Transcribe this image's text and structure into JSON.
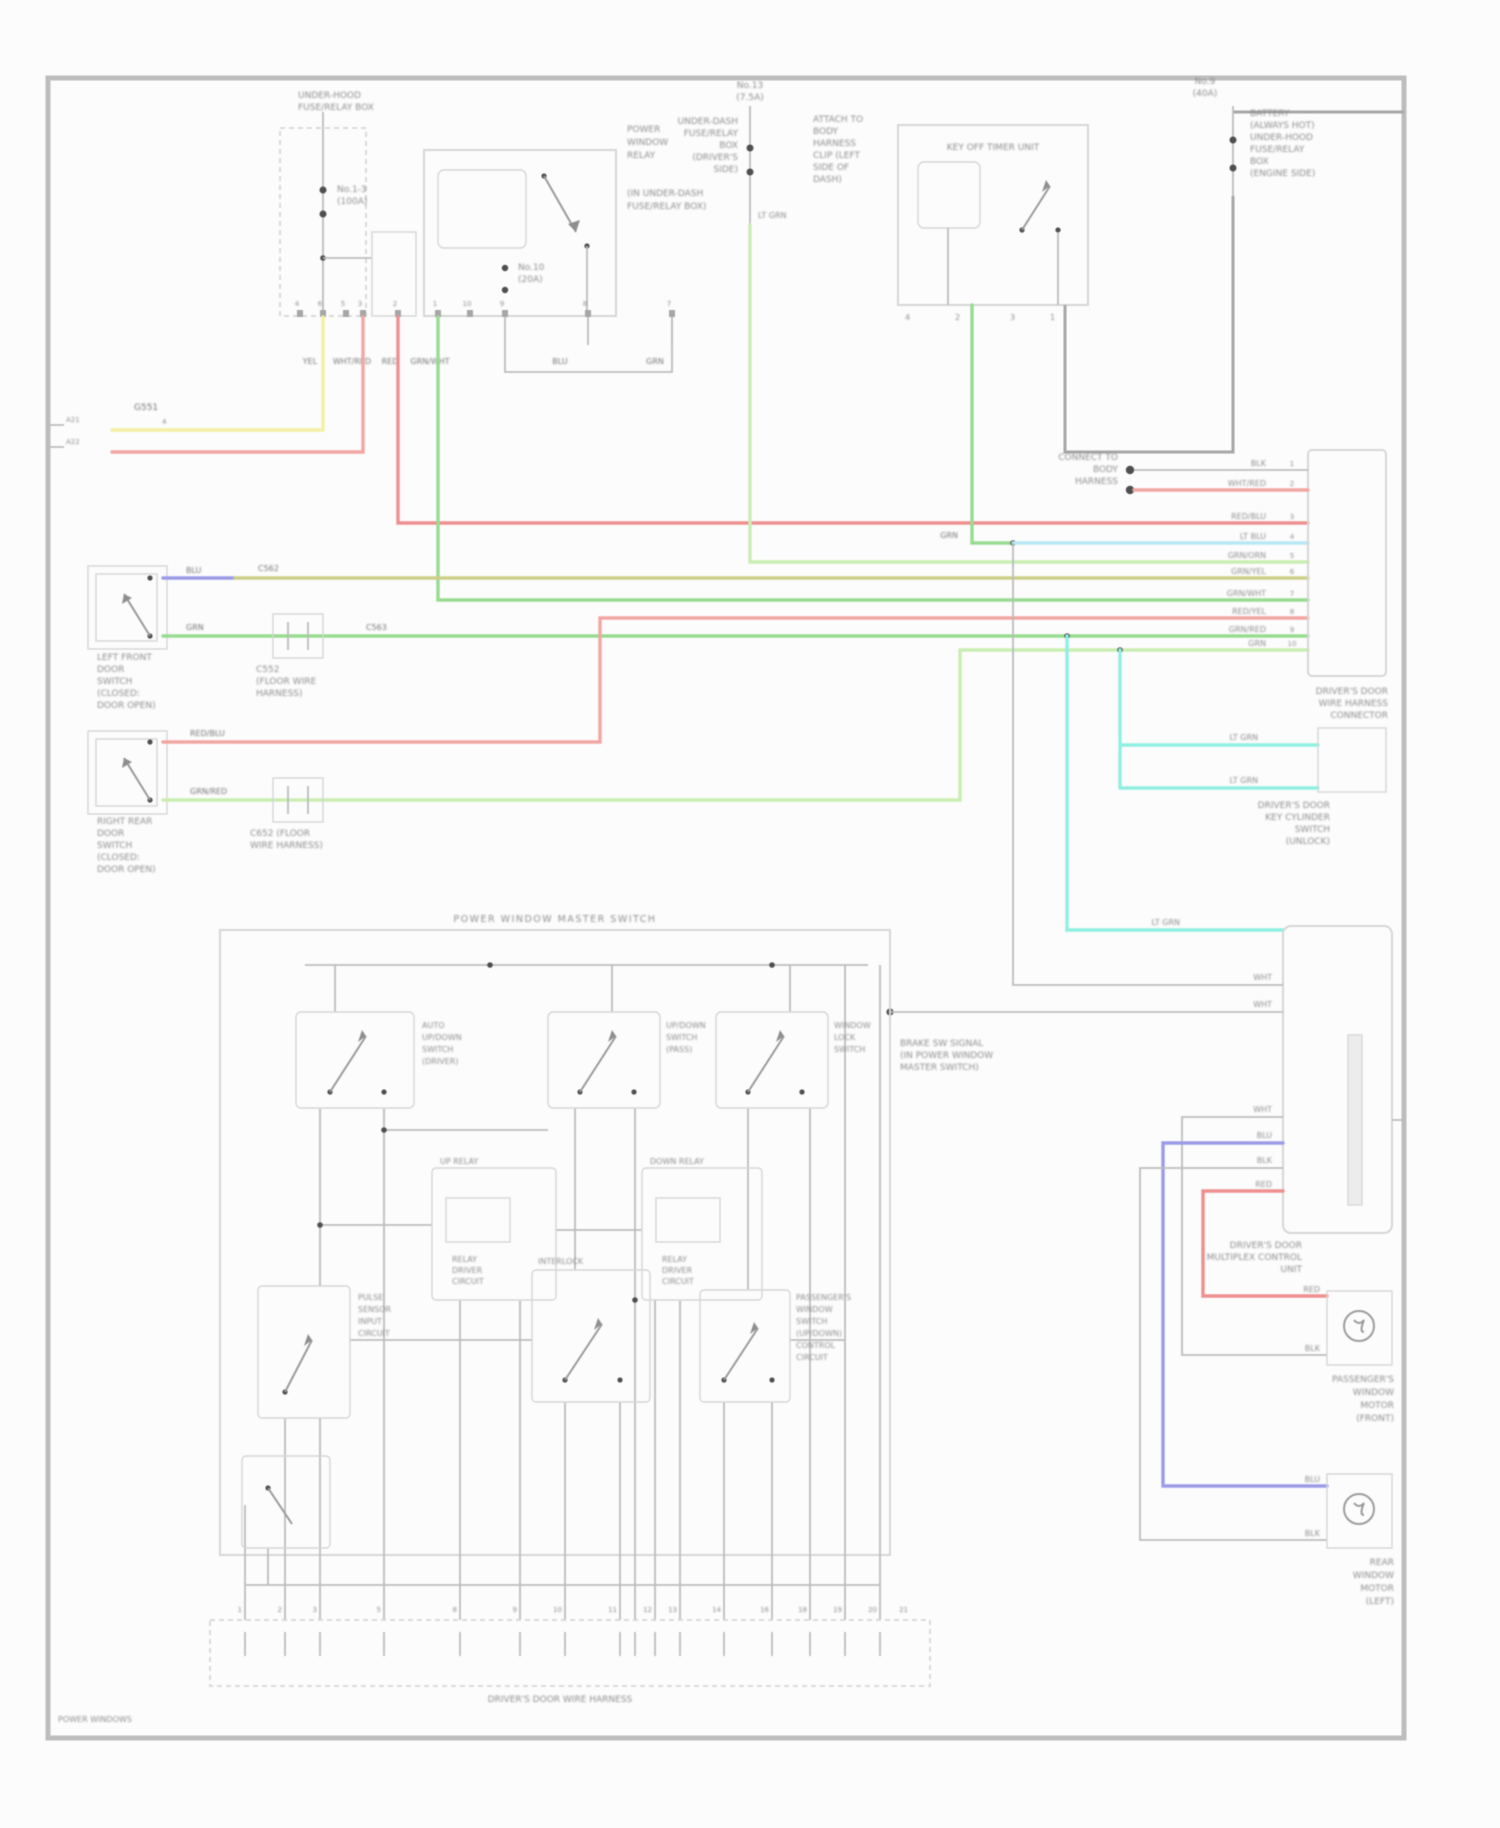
{
  "colors": {
    "page_bg": "#fcfcfc",
    "border": "#bdbdbd",
    "box": "#d6d6d6",
    "wire": "#bcbcbc",
    "wire_dark": "#a6a6a6",
    "text": "#8e8e8e",
    "text_dark": "#767676",
    "yellow": "#f4efa4",
    "red": "#f2a6a2",
    "red2": "#ee8f8f",
    "green": "#97db90",
    "palegreen": "#c9edb2",
    "olive": "#cdd089",
    "ltblue": "#b8e7f3",
    "cyan": "#90f0e2",
    "blue": "#9b9ce8",
    "dot": "#4f4f4f"
  },
  "page": {
    "footer": "POWER WINDOWS"
  },
  "top_left": {
    "box_title": [
      "UNDER-HOOD",
      "FUSE/RELAY BOX"
    ],
    "fuse_a": [
      "No.1-3",
      "(100A)"
    ],
    "fuse_b": [
      "No.10",
      "(20A)"
    ],
    "relay_block": [
      "POWER",
      "WINDOW",
      "RELAY"
    ],
    "relay_block2": [
      "(IN UNDER-DASH",
      "FUSE/RELAY BOX)"
    ],
    "pin_numbers": [
      "4",
      "6",
      "5",
      "3",
      "2",
      "1",
      "10",
      "9",
      "8",
      "7"
    ],
    "wire_codes": [
      "YEL",
      "WHT/RED",
      "RED",
      "GRN/WHT",
      "BLU",
      "GRN"
    ],
    "ground_id": "G551",
    "ground_code": "4",
    "border_ticks": [
      "A21",
      "A22"
    ]
  },
  "mid_fuse": {
    "title": [
      "No.13",
      "(7.5A)"
    ],
    "left": [
      "UNDER-DASH",
      "FUSE/RELAY",
      "BOX",
      "(DRIVER'S",
      "SIDE)"
    ],
    "right": [
      "ATTACH TO",
      "BODY",
      "HARNESS",
      "CLIP (LEFT",
      "SIDE OF",
      "DASH)"
    ],
    "code": "LT GRN"
  },
  "relay2": {
    "title": "KEY OFF TIMER UNIT",
    "pins": [
      "4",
      "2",
      "3",
      "1"
    ],
    "code": "GRN"
  },
  "fuse_r": {
    "title": [
      "No.9",
      "(40A)"
    ],
    "right": [
      "BATTERY",
      "(ALWAYS HOT)",
      "UNDER-HOOD",
      "FUSE/RELAY",
      "BOX",
      "(ENGINE SIDE)"
    ]
  },
  "connector": {
    "dots_label": [
      "CONNECT TO",
      "BODY",
      "HARNESS"
    ],
    "rows": [
      {
        "code": "BLK",
        "pin": "1"
      },
      {
        "code": "WHT/RED",
        "pin": "2"
      },
      {
        "code": "RED/BLU",
        "pin": "3"
      },
      {
        "code": "LT BLU",
        "pin": "4"
      },
      {
        "code": "GRN/ORN",
        "pin": "5"
      },
      {
        "code": "GRN/YEL",
        "pin": "6"
      },
      {
        "code": "GRN/WHT",
        "pin": "7"
      },
      {
        "code": "RED/YEL",
        "pin": "8"
      },
      {
        "code": "GRN/RED",
        "pin": "9"
      },
      {
        "code": "GRN",
        "pin": "10"
      }
    ],
    "label": [
      "DRIVER'S DOOR",
      "WIRE HARNESS",
      "CONNECTOR"
    ]
  },
  "keycyl": {
    "codes": [
      "LT GRN",
      "LT GRN",
      "LT GRN"
    ],
    "label": [
      "DRIVER'S DOOR",
      "KEY CYLINDER",
      "SWITCH",
      "(UNLOCK)"
    ]
  },
  "module": {
    "feed_codes": [
      "WHT",
      "WHT"
    ],
    "feed_label": [
      "BRAKE SW SIGNAL",
      "(IN POWER WINDOW",
      "MASTER SWITCH)"
    ],
    "pin_codes": [
      "WHT",
      "BLU",
      "BLK",
      "RED"
    ],
    "label": [
      "DRIVER'S DOOR",
      "MULTIPLEX CONTROL",
      "UNIT"
    ]
  },
  "motor1": {
    "codes": [
      "RED",
      "BLK"
    ],
    "label": [
      "PASSENGER'S",
      "WINDOW",
      "MOTOR",
      "(FRONT)"
    ]
  },
  "motor2": {
    "codes": [
      "BLU",
      "BLK"
    ],
    "label": [
      "REAR",
      "WINDOW",
      "MOTOR",
      "(LEFT)"
    ]
  },
  "switch1": {
    "codes": [
      "BLU",
      "C562",
      "GRN",
      "C563"
    ],
    "label": [
      "LEFT FRONT",
      "DOOR",
      "SWITCH",
      "(CLOSED:",
      "DOOR OPEN)"
    ],
    "conn_label": [
      "C552",
      "(FLOOR WIRE",
      "HARNESS)"
    ]
  },
  "switch2": {
    "codes": [
      "RED/BLU",
      "GRN/RED"
    ],
    "label": [
      "RIGHT REAR",
      "DOOR",
      "SWITCH",
      "(CLOSED:",
      "DOOR OPEN)"
    ],
    "conn_label": [
      "C652 (FLOOR",
      "WIRE HARNESS)"
    ]
  },
  "master": {
    "title": "POWER WINDOW MASTER SWITCH",
    "cell1": [
      "AUTO",
      "UP/DOWN",
      "SWITCH",
      "(DRIVER)"
    ],
    "cell2": [
      "UP/DOWN",
      "SWITCH",
      "(PASS)"
    ],
    "cell3": [
      "WINDOW",
      "LOCK",
      "SWITCH"
    ],
    "mid1_title": "UP RELAY",
    "mid1": [
      "RELAY",
      "DRIVER",
      "CIRCUIT"
    ],
    "mid2_title": "DOWN RELAY",
    "mid2": [
      "RELAY",
      "DRIVER",
      "CIRCUIT"
    ],
    "low1": [
      "PULSE",
      "SENSOR",
      "INPUT",
      "CIRCUIT"
    ],
    "low2_title": "INTERLOCK",
    "low3": [
      "PASSENGER'S",
      "WINDOW",
      "SWITCH",
      "(UP/DOWN)",
      "CONTROL",
      "CIRCUIT"
    ],
    "pin_labels": [
      "1",
      "2",
      "3",
      "5",
      "8",
      "9",
      "10",
      "11",
      "12",
      "13",
      "14",
      "16",
      "18",
      "19",
      "20",
      "21"
    ],
    "strip_label": "DRIVER'S DOOR WIRE HARNESS"
  }
}
